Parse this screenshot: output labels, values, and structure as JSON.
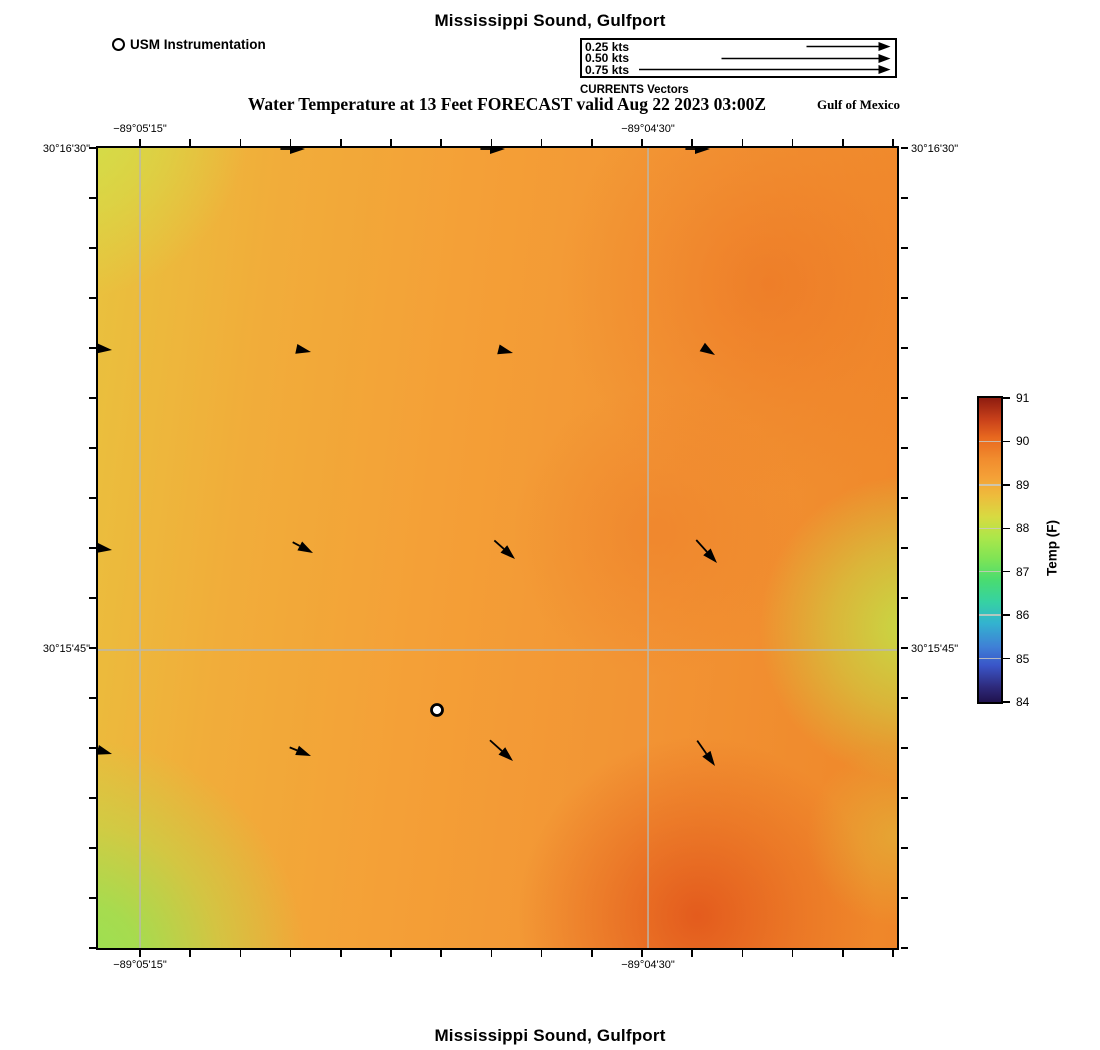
{
  "titles": {
    "top": "Mississippi Sound, Gulfport",
    "subtitle": "Water Temperature at 13 Feet FORECAST valid Aug 22 2023 03:00Z",
    "region_label": "Gulf of Mexico",
    "bottom": "Mississippi Sound, Gulfport"
  },
  "legend": {
    "instrumentation_label": "USM Instrumentation",
    "currents_caption": "CURRENTS Vectors",
    "speeds": [
      "0.25 kts",
      "0.50 kts",
      "0.75 kts"
    ],
    "speed_values_kts": [
      0.25,
      0.5,
      0.75
    ]
  },
  "axes": {
    "top": [
      {
        "text": "−89°05'15\"",
        "fx": 0.0526
      },
      {
        "text": "−89°04'30\"",
        "fx": 0.6884
      }
    ],
    "left": [
      {
        "text": "30°16'30\"",
        "fy": 0.0025
      },
      {
        "text": "30°15'45\"",
        "fy": 0.6275
      }
    ]
  },
  "colorbar": {
    "label": "Temp (F)",
    "min": 84,
    "max": 91,
    "ticks": [
      91,
      90,
      89,
      88,
      87,
      86,
      85,
      84
    ]
  },
  "map": {
    "station": {
      "x": 339,
      "y": 562,
      "label": "USM Instrumentation"
    },
    "vectors": [
      {
        "x": 207,
        "y": 1,
        "a": 0,
        "t": 6
      },
      {
        "x": 407,
        "y": 1,
        "a": 0,
        "t": 6
      },
      {
        "x": 612,
        "y": 1,
        "a": 0,
        "t": 6
      },
      {
        "x": 14,
        "y": 202,
        "a": 6,
        "t": 0
      },
      {
        "x": 213,
        "y": 204,
        "a": 12,
        "t": 0
      },
      {
        "x": 415,
        "y": 205,
        "a": 14,
        "t": 0
      },
      {
        "x": 617,
        "y": 207,
        "a": 32,
        "t": 0
      },
      {
        "x": 14,
        "y": 402,
        "a": 8,
        "t": 0
      },
      {
        "x": 215,
        "y": 405,
        "a": 28,
        "t": 5
      },
      {
        "x": 417,
        "y": 411,
        "a": 42,
        "t": 8
      },
      {
        "x": 619,
        "y": 415,
        "a": 48,
        "t": 10
      },
      {
        "x": 14,
        "y": 606,
        "a": 16,
        "t": 0
      },
      {
        "x": 213,
        "y": 608,
        "a": 22,
        "t": 5
      },
      {
        "x": 415,
        "y": 613,
        "a": 42,
        "t": 10
      },
      {
        "x": 617,
        "y": 618,
        "a": 55,
        "t": 10
      }
    ]
  },
  "chart_data": {
    "type": "heatmap",
    "title": "Mississippi Sound, Gulfport",
    "subtitle": "Water Temperature at 13 Feet FORECAST valid Aug 22 2023 03:00Z",
    "field": "Water temperature at 13 ft depth, forecast valid Aug 22 2023 03:00Z",
    "region_note": "Gulf of Mexico",
    "x_axis": {
      "label": "Longitude",
      "ticks": [
        "−89°05'15\"",
        "−89°04'30\""
      ],
      "tick_interval": "45 arcsec between labeled gridlines"
    },
    "y_axis": {
      "label": "Latitude",
      "ticks": [
        "30°16'30\"",
        "30°15'45\""
      ],
      "tick_interval": "45 arcsec between labeled gridlines"
    },
    "colorbar": {
      "label": "Temp (F)",
      "range": [
        84,
        91
      ],
      "ticks": [
        84,
        85,
        86,
        87,
        88,
        89,
        90,
        91
      ]
    },
    "grid": true,
    "legend_position": "colorbar right of map",
    "temperature_grid_F": {
      "description": "Approximate temperatures read from the color field; rows north to south, columns west to east",
      "rows": [
        [
          88.3,
          88.9,
          89.2,
          89.5,
          89.4
        ],
        [
          88.4,
          89.0,
          89.3,
          89.6,
          88.8
        ],
        [
          88.3,
          89.1,
          89.3,
          89.4,
          88.1
        ],
        [
          88.0,
          89.0,
          89.2,
          89.6,
          88.8
        ],
        [
          87.9,
          88.4,
          89.1,
          90.2,
          89.2
        ]
      ]
    },
    "current_vectors": {
      "reference_speeds_kts": [
        0.25,
        0.5,
        0.75
      ],
      "note": "All plotted vectors are weaker than 0.25 kts; flow is eastward in the north, turning southeastward toward the south and east",
      "approx_directions_deg_clockwise_from_east": [
        [
          0,
          0,
          0
        ],
        [
          6,
          12,
          14,
          32
        ],
        [
          8,
          28,
          42,
          48
        ],
        [
          16,
          22,
          42,
          55
        ]
      ]
    },
    "station": {
      "label": "USM Instrumentation",
      "marker": "white circle with black outline",
      "location": "south-central area of map"
    }
  }
}
